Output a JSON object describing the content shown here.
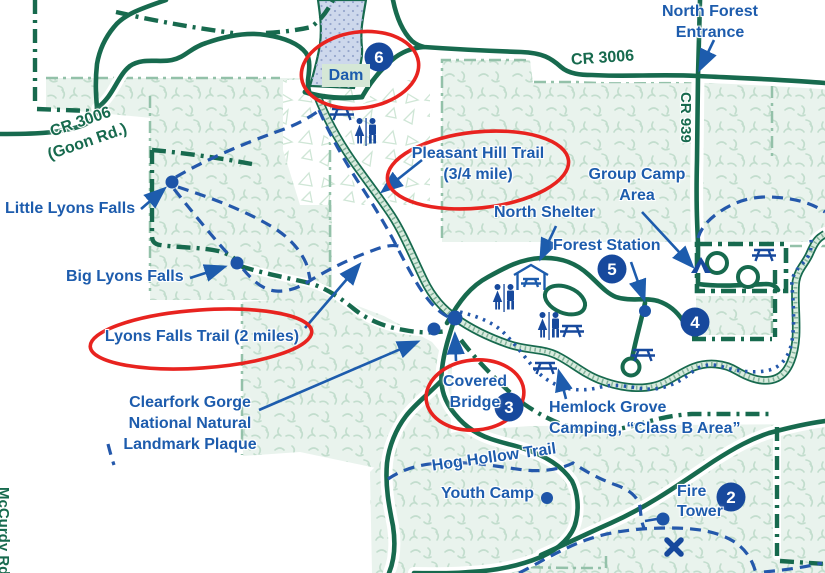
{
  "map": {
    "title": "Forest park trail map",
    "road_labels": {
      "cr3006_top": "CR 3006",
      "cr939": "CR 939",
      "cr3006_goon_line1": "CR 3006",
      "cr3006_goon_line2": "(Goon Rd.)",
      "mccurdy": "McCurdy Rd."
    },
    "labels": {
      "north_forest_entrance": {
        "line1": "North Forest",
        "line2": "Entrance"
      },
      "dam": "Dam",
      "pleasant_hill_trail": {
        "line1": "Pleasant Hill Trail",
        "line2": "(3/4 mile)"
      },
      "group_camp_area": {
        "line1": "Group Camp",
        "line2": "Area"
      },
      "north_shelter": "North Shelter",
      "forest_station": "Forest Station",
      "little_lyons_falls": "Little Lyons Falls",
      "big_lyons_falls": "Big Lyons Falls",
      "lyons_falls_trail": "Lyons Falls Trail (2 miles)",
      "clearfork_gorge": {
        "line1": "Clearfork Gorge",
        "line2": "National Natural",
        "line3": "Landmark Plaque"
      },
      "covered_bridge": {
        "line1": "Covered",
        "line2": "Bridge"
      },
      "hemlock_grove": {
        "line1": "Hemlock Grove",
        "line2": "Camping, “Class B Area”"
      },
      "hog_hollow_trail": "Hog Hollow Trail",
      "youth_camp": "Youth Camp",
      "fire_tower": {
        "line1": "Fire",
        "line2": "Tower"
      }
    },
    "badges": {
      "b2": "2",
      "b3": "3",
      "b4": "4",
      "b5": "5",
      "b6": "6"
    },
    "icons": [
      "picnic-table-icon",
      "restroom-icon",
      "shelter-icon",
      "tent-icon",
      "x-marker-icon",
      "poi-dot"
    ],
    "colors": {
      "road_green": "#176a4e",
      "label_blue": "#1d5cad",
      "trail_blue": "#2458ab",
      "badge_navy": "#17499d",
      "highlight_red": "#e8231f",
      "water_fill": "#cdd8ec",
      "forest_fill": "#e9f3ed"
    }
  }
}
